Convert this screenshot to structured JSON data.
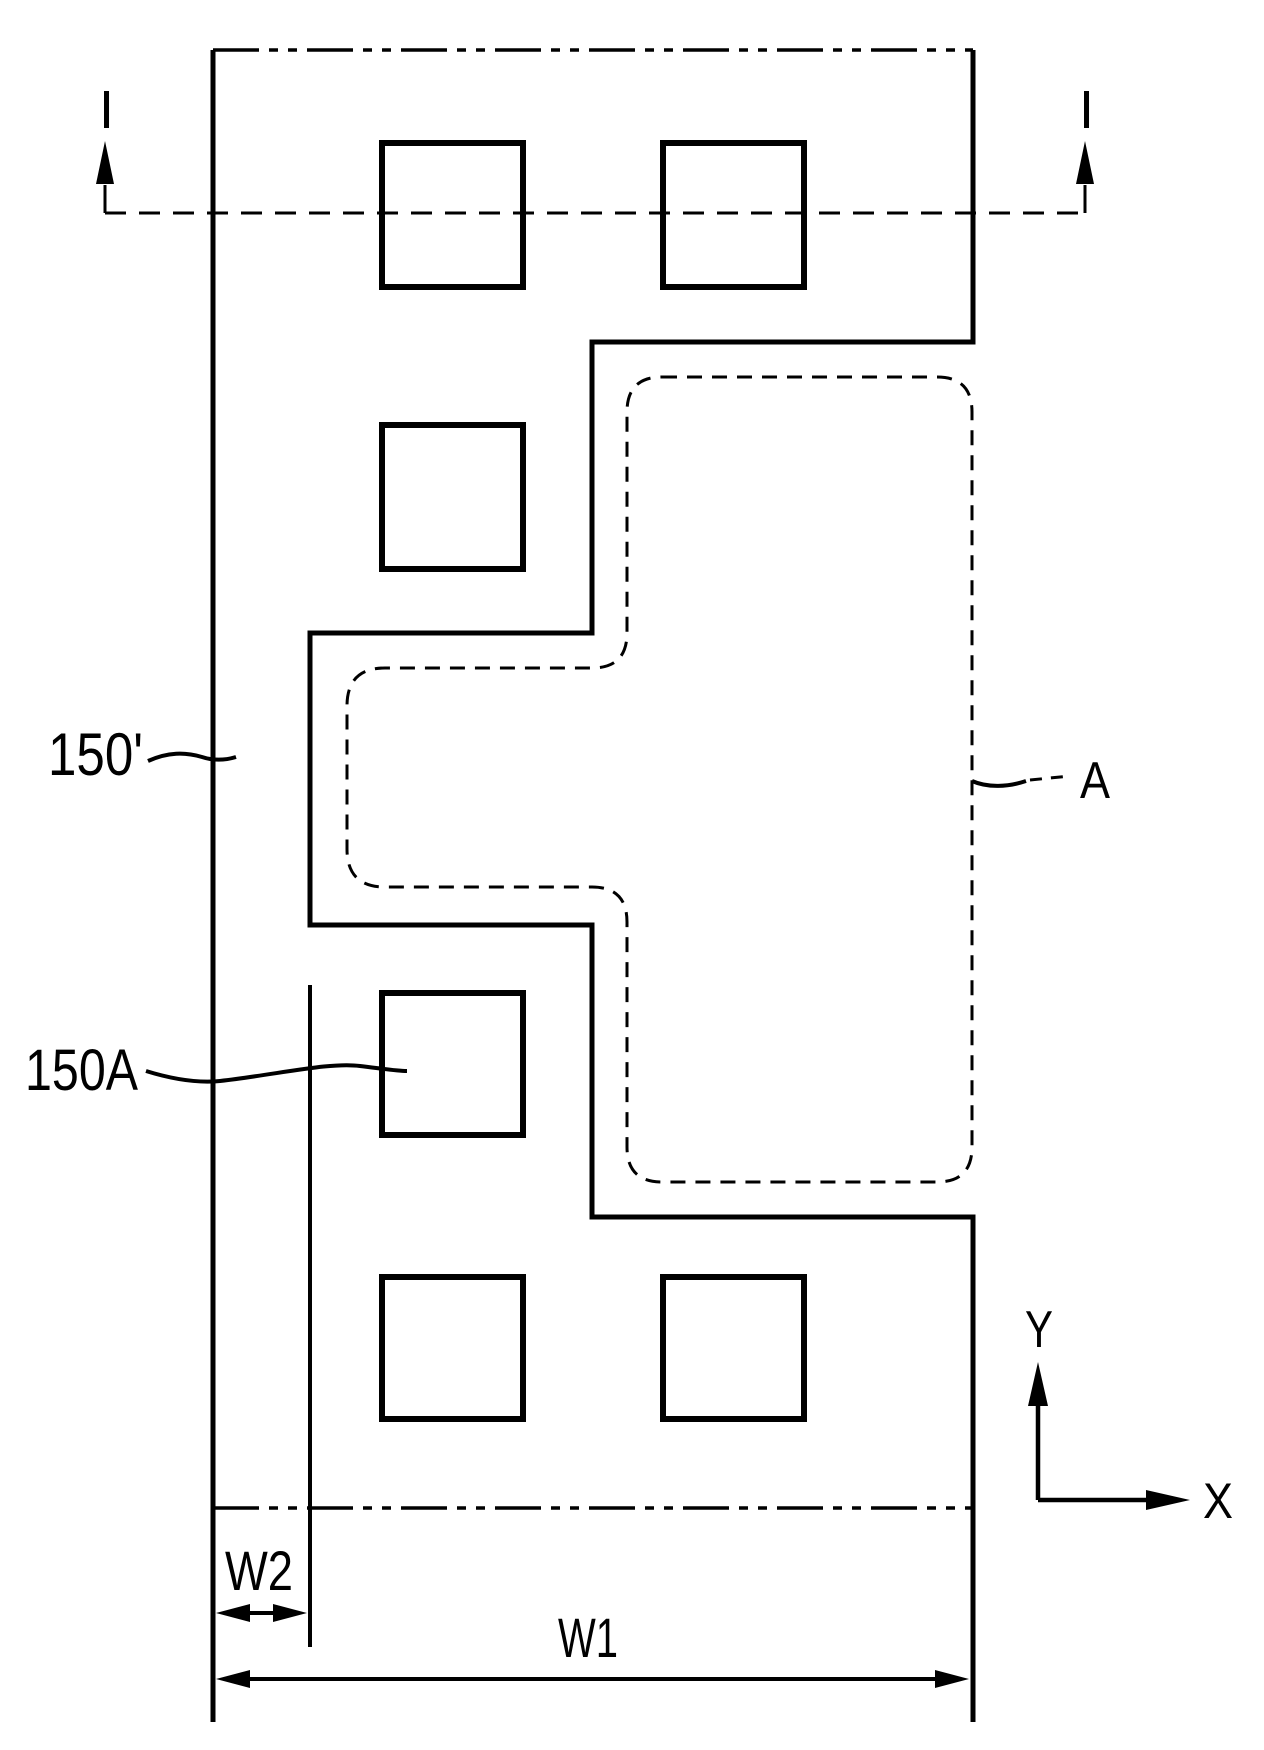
{
  "figure": {
    "type": "patent-layout-plan-view",
    "background_color": "#ffffff",
    "line_color": "#000000",
    "labels": {
      "pattern_line": "150'",
      "contact_pad": "150A",
      "dashed_region": "A"
    },
    "section_markers": {
      "left": "I",
      "right": "I"
    },
    "dimensions": {
      "total_width": "W1",
      "edge_offset": "W2"
    },
    "axes": {
      "horizontal": "X",
      "vertical": "Y"
    }
  }
}
